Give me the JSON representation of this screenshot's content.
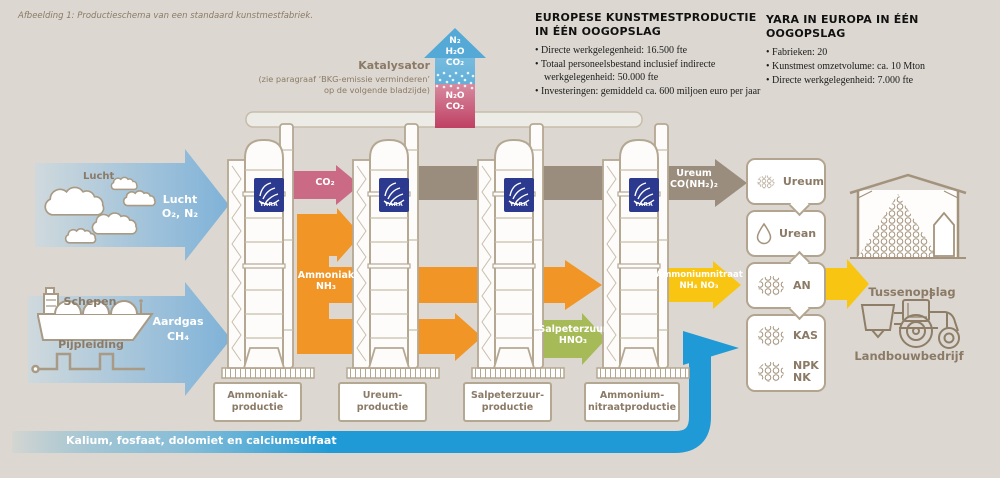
{
  "caption": "Afbeelding 1: Productieschema van een standaard kunstmestfabriek.",
  "info_europe": {
    "title": "EUROPESE KUNSTMESTPRODUCTIE IN ÉÉN OOGOPSLAG",
    "bullets": [
      "Directe werkgelegenheid: 16.500 fte",
      "Totaal personeelsbestand inclusief indirecte werkgelegenheid: 50.000 fte",
      "Investeringen: gemiddeld ca. 600 miljoen euro per jaar"
    ]
  },
  "info_yara": {
    "title": "YARA IN EUROPA IN ÉÉN OOGOPSLAG",
    "bullets": [
      "Fabrieken: 20",
      "Kunstmest omzetvolume: ca. 10 Mton",
      "Directe werkgelegenheid: 7.000 fte"
    ]
  },
  "catalyst": {
    "label": "Katalysator",
    "note1": "(zie paragraaf ‘BKG-emissie verminderen’",
    "note2": "op de volgende bladzijde)",
    "out": [
      "N₂",
      "H₂O",
      "CO₂"
    ],
    "in": [
      "N₂O",
      "CO₂"
    ]
  },
  "inputs": {
    "air_label": "Lucht",
    "air_inside": "Lucht",
    "air_formula": "O₂, N₂",
    "ships_label": "Schepen",
    "pipeline_label": "Pijpleiding",
    "gas_inside": "Aardgas",
    "gas_formula": "CH₄",
    "minerals": "Kalium, fosfaat, dolomiet en calciumsulfaat"
  },
  "flows": {
    "co2": "CO₂",
    "ammonia": "Ammoniak",
    "ammonia_formula": "NH₃",
    "urea": "Ureum",
    "urea_formula": "CO(NH₂)₂",
    "nitric": "Salpeterzuur",
    "nitric_formula": "HNO₃",
    "ammonium_nitrate": "Ammoniumnitraat",
    "ammonium_nitrate_formula": "NH₄ NO₃"
  },
  "plants": [
    {
      "line1": "Ammoniak-",
      "line2": "productie"
    },
    {
      "line1": "Ureum-",
      "line2": "productie"
    },
    {
      "line1": "Salpeterzuur-",
      "line2": "productie"
    },
    {
      "line1": "Ammonium-",
      "line2": "nitraatproductie"
    }
  ],
  "products": {
    "ureum": "Ureum",
    "urean": "Urean",
    "an": "AN",
    "kas": "KAS",
    "npk_line1": "NPK",
    "npk_line2": "NK"
  },
  "destinations": {
    "storage": "Tussenopslag",
    "farm": "Landbouwbedrijf"
  },
  "brand": {
    "logo": "YARA"
  },
  "colors": {
    "background": "#dcd8d1",
    "text_brown": "#8b7a66",
    "input_blue": "#7fb2d8",
    "mineral_blue": "#1f9ad6",
    "ammonia_orange": "#f09526",
    "an_yellow": "#f9c513",
    "nitric_green": "#a6ba58",
    "co2_pink": "#cb6a85",
    "urea_brown": "#9b8d7d",
    "catalyst_blue": "#55a9d7",
    "catalyst_red": "#c24566",
    "yara_navy": "#2b3a8e"
  }
}
